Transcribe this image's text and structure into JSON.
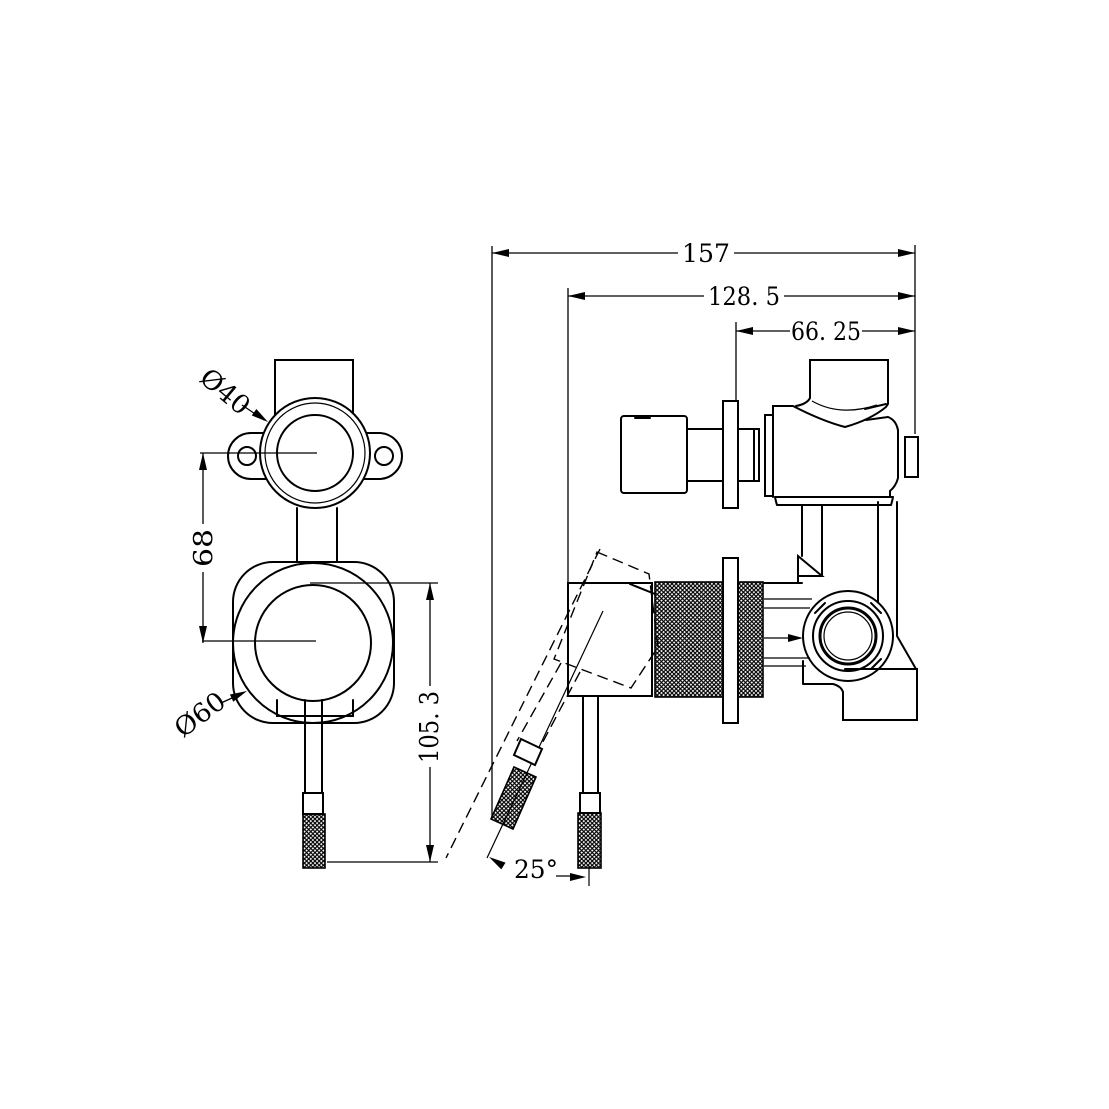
{
  "drawing": {
    "type": "technical-dimension-drawing",
    "subject": "wall-mixer-valve-with-diverter",
    "line_color": "#000000",
    "background_color": "#ffffff",
    "side_view": {
      "dim_overall_depth": "157",
      "dim_body_depth": "128. 5",
      "dim_rear_depth": "66. 25",
      "dim_lever_angle": "25°"
    },
    "front_view": {
      "dim_top_port_diameter": "Ø40",
      "dim_handle_diameter": "Ø60",
      "dim_port_center_spacing": "68",
      "dim_handle_length": "105. 3"
    }
  }
}
